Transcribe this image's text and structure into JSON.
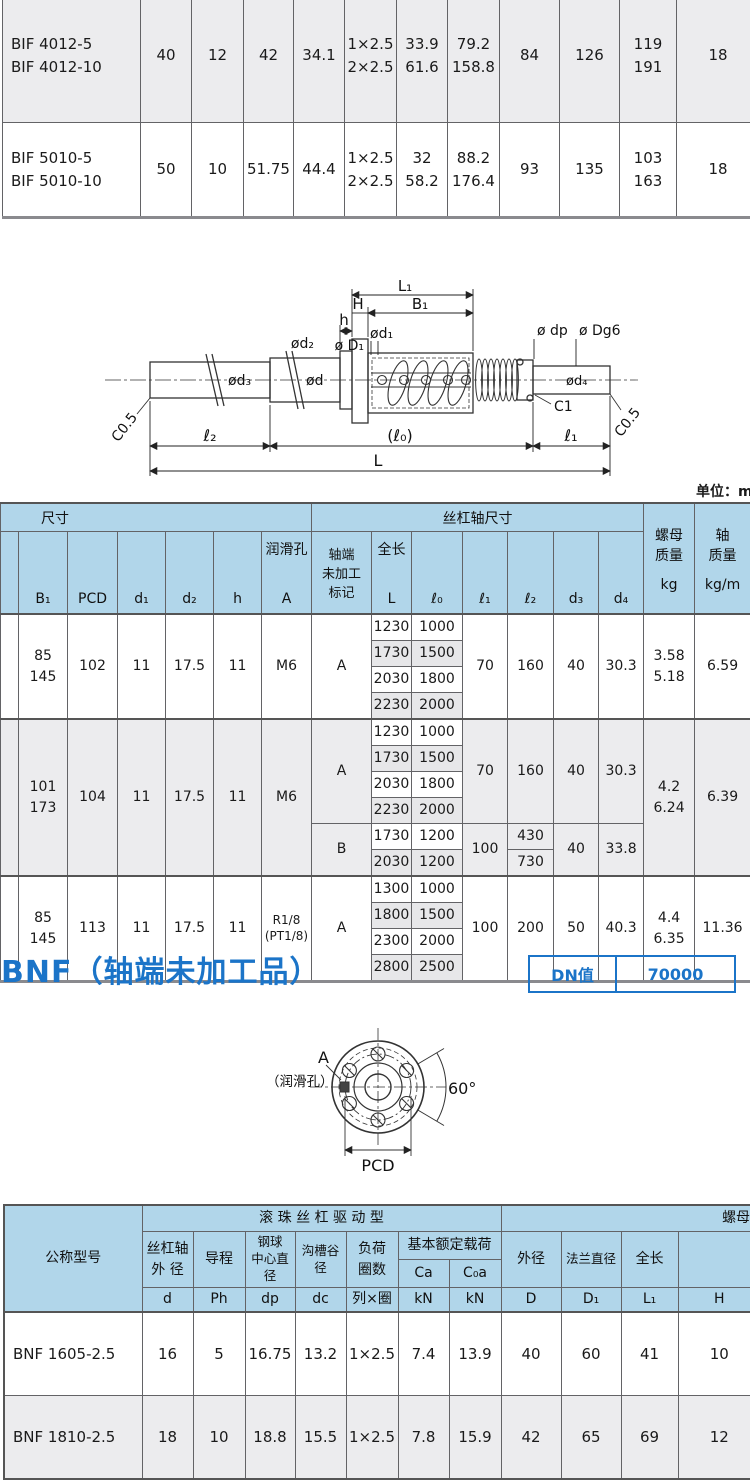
{
  "unit_note": "单位：mm",
  "section": {
    "title": "BNF（轴端未加工品）",
    "dn_label": "DN值",
    "dn_value": "70000"
  },
  "colors": {
    "accent_blue": "#1b74c8",
    "header_blue": "#b1d6ea",
    "row_gray": "#ececee"
  },
  "bif_table": {
    "rows": [
      {
        "model": "BIF 4012-5\nBIF 4012-10",
        "d": "40",
        "ph": "12",
        "dp": "42",
        "dc": "34.1",
        "circuits": "1×2.5\n2×2.5",
        "ca": "33.9\n61.6",
        "c0a": "79.2\n158.8",
        "D": "84",
        "D1": "126",
        "L1": "119\n191",
        "H": "18"
      },
      {
        "model": "BIF 5010-5\nBIF 5010-10",
        "d": "50",
        "ph": "10",
        "dp": "51.75",
        "dc": "44.4",
        "circuits": "1×2.5\n2×2.5",
        "ca": "32\n58.2",
        "c0a": "88.2\n176.4",
        "D": "93",
        "D1": "135",
        "L1": "103\n163",
        "H": "18"
      }
    ]
  },
  "side_diagram": {
    "dims": {
      "L1": "L₁",
      "H": "H",
      "B1": "B₁",
      "h": "h",
      "d1": "ød₁",
      "d2": "ød₂",
      "d3": "ød₃",
      "d": "ød",
      "D1": "ø D₁",
      "dp": "ø dp",
      "dg6": "ø Dg6",
      "d4": "ød₄",
      "c1": "C1",
      "c05_left": "C0.5",
      "c05_right": "C0.5",
      "l2": "ℓ₂",
      "l0": "(ℓ₀)",
      "l1": "ℓ₁",
      "L": "L"
    }
  },
  "dim_table": {
    "header": {
      "size_group": "尺寸",
      "shaft_group": "丝杠轴尺寸",
      "nut_mass": "螺母\n质量",
      "nut_mass_unit": "kg",
      "shaft_mass": "轴\n质量",
      "shaft_mass_unit": "kg/m",
      "B1": "B₁",
      "PCD": "PCD",
      "d1": "d₁",
      "d2": "d₂",
      "h": "h",
      "lube": "润滑孔",
      "lube_sym": "A",
      "mark": "轴端\n未加工\n标记",
      "length": "全长",
      "length_sym": "L",
      "l0": "ℓ₀",
      "l1": "ℓ₁",
      "l2": "ℓ₂",
      "d3": "d₃",
      "d4": "d₄"
    },
    "groups": [
      {
        "B1": "85\n145",
        "PCD": "102",
        "d1": "11",
        "d2": "17.5",
        "h": "11",
        "A": "M6",
        "kg": "3.58\n5.18",
        "kgm": "6.59",
        "subs": [
          {
            "mark": "A",
            "l1": "70",
            "l2": "160",
            "d3": "40",
            "d4": "30.3",
            "rows": [
              {
                "L": "1230",
                "l0": "1000"
              },
              {
                "L": "1730",
                "l0": "1500"
              },
              {
                "L": "2030",
                "l0": "1800"
              },
              {
                "L": "2230",
                "l0": "2000"
              }
            ]
          }
        ]
      },
      {
        "B1": "101\n173",
        "PCD": "104",
        "d1": "11",
        "d2": "17.5",
        "h": "11",
        "A": "M6",
        "kg": "4.2\n6.24",
        "kgm": "6.39",
        "subs": [
          {
            "mark": "A",
            "l1": "70",
            "l2": "160",
            "d3": "40",
            "d4": "30.3",
            "rows": [
              {
                "L": "1230",
                "l0": "1000"
              },
              {
                "L": "1730",
                "l0": "1500"
              },
              {
                "L": "2030",
                "l0": "1800"
              },
              {
                "L": "2230",
                "l0": "2000"
              }
            ]
          },
          {
            "mark": "B",
            "l1": "100",
            "l2a": "430",
            "l2b": "730",
            "d3": "40",
            "d4": "33.8",
            "rows": [
              {
                "L": "1730",
                "l0": "1200"
              },
              {
                "L": "2030",
                "l0": "1200"
              }
            ]
          }
        ]
      },
      {
        "B1": "85\n145",
        "PCD": "113",
        "d1": "11",
        "d2": "17.5",
        "h": "11",
        "A": "R1/8\n(PT1/8)",
        "kg": "4.4\n6.35",
        "kgm": "11.36",
        "subs": [
          {
            "mark": "A",
            "l1": "100",
            "l2": "200",
            "d3": "50",
            "d4": "40.3",
            "rows": [
              {
                "L": "1300",
                "l0": "1000"
              },
              {
                "L": "1800",
                "l0": "1500"
              },
              {
                "L": "2300",
                "l0": "2000"
              },
              {
                "L": "2800",
                "l0": "2500"
              }
            ]
          }
        ]
      }
    ]
  },
  "flange_diagram": {
    "a_label": "A",
    "lube_note": "（润滑孔）",
    "angle": "60°",
    "pcd": "PCD"
  },
  "bnf_table": {
    "header": {
      "model": "公称型号",
      "drive_group": "滚 珠 丝 杠 驱 动 型",
      "nut_group": "螺母",
      "shaft_od": "丝杠轴\n外 径",
      "lead": "导程",
      "ball_dia": "钢球\n中心直径",
      "root_dia": "沟槽谷径",
      "circuits": "负荷\n圈数",
      "load": "基本额定载荷",
      "ca": "Ca",
      "c0a": "C₀a",
      "d": "d",
      "ph": "Ph",
      "dp": "dp",
      "dc": "dc",
      "cir": "列×圈",
      "kn1": "kN",
      "kn2": "kN",
      "od": "外径",
      "flange_dia": "法兰直径",
      "length": "全长",
      "D": "D",
      "D1": "D₁",
      "L1": "L₁",
      "H": "H"
    },
    "rows": [
      {
        "model": "BNF 1605-2.5",
        "d": "16",
        "ph": "5",
        "dp": "16.75",
        "dc": "13.2",
        "cir": "1×2.5",
        "ca": "7.4",
        "c0a": "13.9",
        "D": "40",
        "D1": "60",
        "L1": "41",
        "H": "10"
      },
      {
        "model": "BNF 1810-2.5",
        "d": "18",
        "ph": "10",
        "dp": "18.8",
        "dc": "15.5",
        "cir": "1×2.5",
        "ca": "7.8",
        "c0a": "15.9",
        "D": "42",
        "D1": "65",
        "L1": "69",
        "H": "12"
      }
    ]
  }
}
